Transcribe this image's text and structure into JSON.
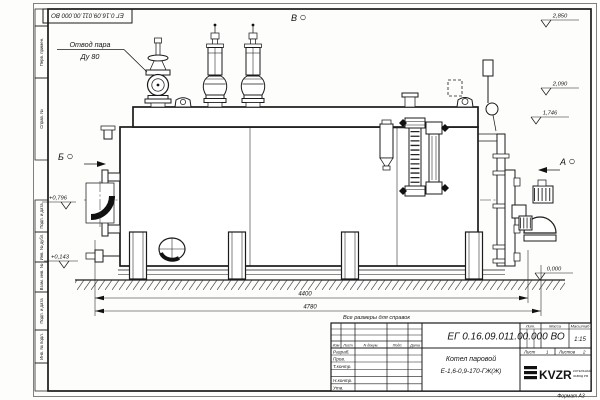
{
  "frame": {
    "top_stamp": "ЕГ 0.16.09.011.00.000 ВО",
    "format_label": "Формат А3",
    "margin_labels": {
      "perv": "Перв. примен.",
      "sprav": "Справ. №",
      "podp1": "Подп. и дата",
      "inv_dubl": "Инв. № дубл.",
      "vzam": "Взам. инв. №",
      "podp2": "Подп. и дата",
      "inv_podl": "Инв. № подл."
    }
  },
  "annotations": {
    "steam_outlet_line1": "Отвод пара",
    "steam_outlet_line2": "Ду 80",
    "reference_note": "Все размеры для справок",
    "view_b": "Б",
    "view_v": "В",
    "view_a": "А"
  },
  "elevations": {
    "top": "2,850",
    "drum": "2,090",
    "shell_top": "1,746",
    "burner": "+0,796",
    "base": "+0,143",
    "ground": "0,000"
  },
  "dimensions": {
    "inner": "4400",
    "overall": "4780"
  },
  "title_block": {
    "doc_number": "ЕГ 0.16.09.011.00.000 ВО",
    "product_name": "Котел паровой",
    "product_model": "Е-1,6-0,9-170-ГЖ(Ж)",
    "scale": "1:15",
    "sheet_label": "Лист",
    "sheet_no": "1",
    "sheets_label": "Листов",
    "sheets_no": "2",
    "headers": {
      "izm": "Изм",
      "list": "Лист",
      "ndoc": "N докум.",
      "podp": "Подп.",
      "data": "Дата",
      "lit": "Лит.",
      "massa": "Масса",
      "scale_h": "Масштаб"
    },
    "rows": {
      "razrab": "Разраб.",
      "prov": "Пров.",
      "tkontr": "Т.контр.",
      "nkontr": "Н.контр.",
      "utv": "Утв."
    },
    "logo": {
      "text": "KVZR",
      "sub1": "КОТЕЛЬНЫЙ",
      "sub2": "ЗАВОД РФ"
    }
  }
}
